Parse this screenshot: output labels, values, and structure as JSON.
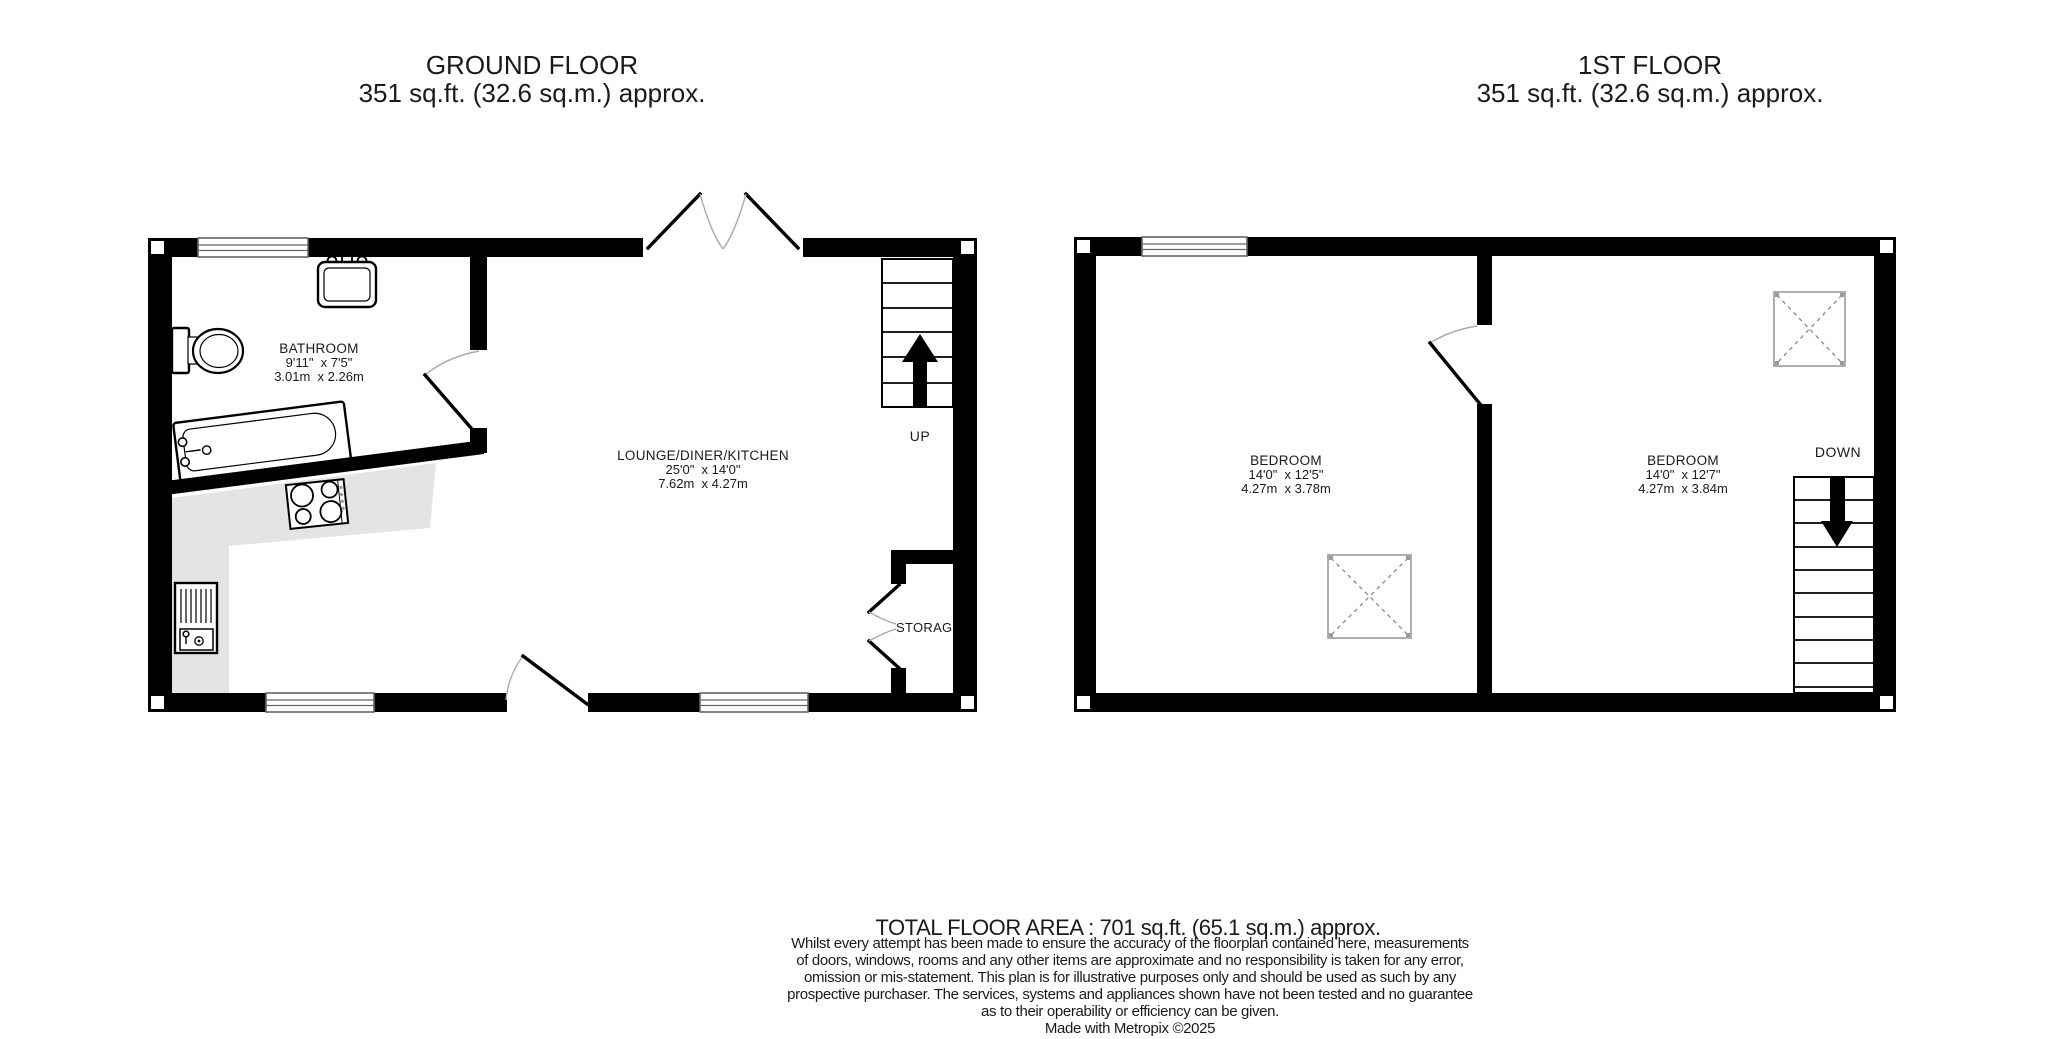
{
  "ground_floor": {
    "title_line1": "GROUND FLOOR",
    "title_line2": "351 sq.ft. (32.6 sq.m.) approx.",
    "stairs_label": "UP",
    "rooms": {
      "bathroom": {
        "name": "BATHROOM",
        "imperial": "9'11\"  x 7'5\"",
        "metric": "3.01m  x 2.26m"
      },
      "lounge": {
        "name": "LOUNGE/DINER/KITCHEN",
        "imperial": "25'0\"  x 14'0\"",
        "metric": "7.62m  x 4.27m"
      },
      "storage": {
        "name": "STORAGE"
      }
    }
  },
  "first_floor": {
    "title_line1": "1ST FLOOR",
    "title_line2": "351 sq.ft. (32.6 sq.m.) approx.",
    "stairs_label": "DOWN",
    "rooms": {
      "bedroom1": {
        "name": "BEDROOM",
        "imperial": "14'0\"  x 12'5\"",
        "metric": "4.27m  x 3.78m"
      },
      "bedroom2": {
        "name": "BEDROOM",
        "imperial": "14'0\"  x 12'7\"",
        "metric": "4.27m  x 3.84m"
      }
    }
  },
  "footer": {
    "total_area": "TOTAL FLOOR AREA : 701 sq.ft. (65.1 sq.m.) approx.",
    "disclaimer_lines": [
      "Whilst every attempt has been made to ensure the accuracy of the floorplan contained here, measurements",
      "of doors, windows, rooms and any other items are approximate and no responsibility is taken for any error,",
      "omission or mis-statement. This plan is for illustrative purposes only and should be used as such by any",
      "prospective purchaser. The services, systems and appliances shown have not been tested and no guarantee",
      "as to their operability or efficiency can be given."
    ],
    "credit": "Made with Metropix ©2025"
  },
  "colors": {
    "wall": "#000000",
    "counter": "#e4e4e4",
    "window_stroke": "#666666",
    "background": "#ffffff"
  }
}
